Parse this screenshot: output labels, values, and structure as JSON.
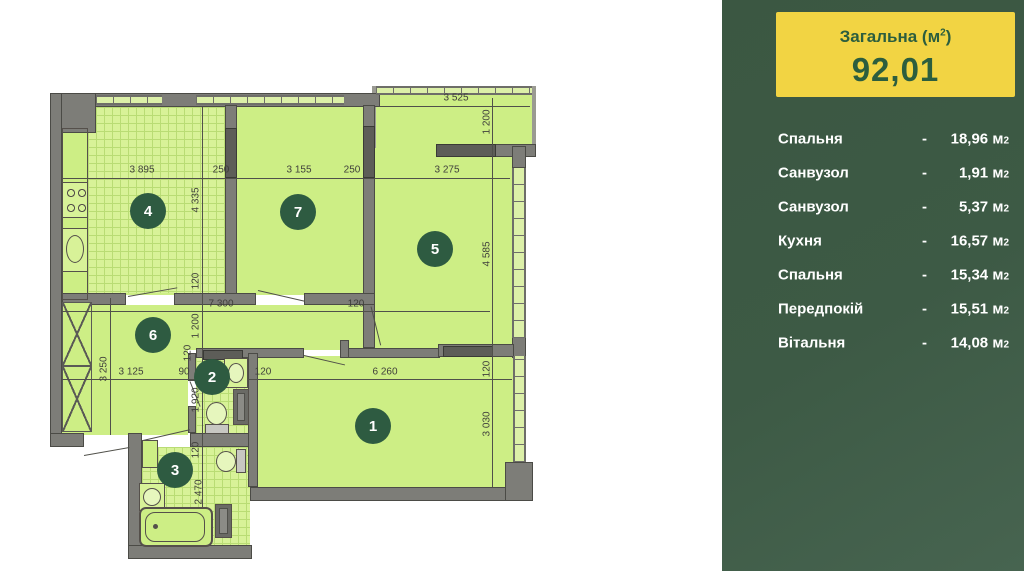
{
  "panel": {
    "dash": "-",
    "unit": "м",
    "unit_sup": "2",
    "colors": {
      "background_green": "#3d5a45",
      "card_yellow": "#f2d443",
      "card_text_green": "#2c5e3e",
      "room_fill_green": "#cdee85",
      "circle_green": "#2e5b41"
    },
    "total": {
      "label": "Загальна (м",
      "sup": "2",
      "label_close": ")",
      "value": "92,01"
    },
    "rooms": [
      {
        "name": "Спальня",
        "value": "18,96"
      },
      {
        "name": "Санвузол",
        "value": "1,91"
      },
      {
        "name": "Санвузол",
        "value": "5,37"
      },
      {
        "name": "Кухня",
        "value": "16,57"
      },
      {
        "name": "Спальня",
        "value": "15,34"
      },
      {
        "name": "Передпокій",
        "value": "15,51"
      },
      {
        "name": "Вітальня",
        "value": "14,08"
      }
    ]
  },
  "plan": {
    "numbers": [
      {
        "t": "1",
        "x": 373,
        "y": 426
      },
      {
        "t": "2",
        "x": 212,
        "y": 377
      },
      {
        "t": "3",
        "x": 175,
        "y": 470
      },
      {
        "t": "4",
        "x": 148,
        "y": 211
      },
      {
        "t": "5",
        "x": 435,
        "y": 249
      },
      {
        "t": "6",
        "x": 153,
        "y": 335
      },
      {
        "t": "7",
        "x": 298,
        "y": 212
      }
    ],
    "dims": [
      {
        "t": "3 895",
        "x": 142,
        "y": 170,
        "v": 0
      },
      {
        "t": "250",
        "x": 221,
        "y": 170,
        "v": 0
      },
      {
        "t": "3 155",
        "x": 299,
        "y": 170,
        "v": 0
      },
      {
        "t": "250",
        "x": 352,
        "y": 170,
        "v": 0
      },
      {
        "t": "3 275",
        "x": 447,
        "y": 170,
        "v": 0
      },
      {
        "t": "3 525",
        "x": 456,
        "y": 98,
        "v": 0
      },
      {
        "t": "7 300",
        "x": 221,
        "y": 304,
        "v": 0
      },
      {
        "t": "120",
        "x": 356,
        "y": 304,
        "v": 0
      },
      {
        "t": "3 125",
        "x": 131,
        "y": 372,
        "v": 0
      },
      {
        "t": "90",
        "x": 184,
        "y": 372,
        "v": 0
      },
      {
        "t": "120",
        "x": 263,
        "y": 372,
        "v": 0
      },
      {
        "t": "6 260",
        "x": 385,
        "y": 372,
        "v": 0
      },
      {
        "t": "1 200",
        "x": 487,
        "y": 122,
        "v": 1
      },
      {
        "t": "4 335",
        "x": 196,
        "y": 200,
        "v": 1
      },
      {
        "t": "120",
        "x": 196,
        "y": 281,
        "v": 1
      },
      {
        "t": "1 200",
        "x": 196,
        "y": 326,
        "v": 1
      },
      {
        "t": "120",
        "x": 188,
        "y": 353,
        "v": 1
      },
      {
        "t": "1 920",
        "x": 196,
        "y": 400,
        "v": 1
      },
      {
        "t": "120",
        "x": 196,
        "y": 450,
        "v": 1
      },
      {
        "t": "2 470",
        "x": 199,
        "y": 492,
        "v": 1
      },
      {
        "t": "4 585",
        "x": 487,
        "y": 254,
        "v": 1
      },
      {
        "t": "120",
        "x": 487,
        "y": 369,
        "v": 1
      },
      {
        "t": "3 030",
        "x": 487,
        "y": 424,
        "v": 1
      },
      {
        "t": "3 250",
        "x": 104,
        "y": 369,
        "v": 1
      }
    ]
  }
}
